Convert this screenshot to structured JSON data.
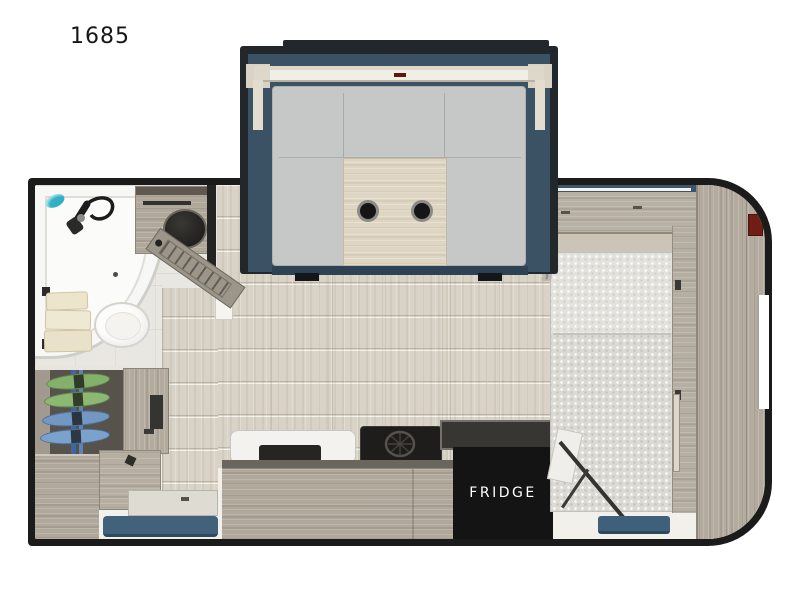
{
  "floorplan": {
    "labels": {
      "model": "1685",
      "fridge": "FRIDGE"
    },
    "colors": {
      "wall_black": "#1b1b1b",
      "slide_wall_blue": "#3a5264",
      "slide_trim_cream": "#ded8ca",
      "cushion_gray": "#c6c8c7",
      "table_wood": "#ded6c3",
      "cabinet_wood": "#b3ab9e",
      "floor_plank": "#d8d3c6",
      "bath_floor": "#e9e7e1",
      "step_mat_blue": "#42617a",
      "gear_green": "#84b06b",
      "gear_blue": "#7197c2",
      "marker_red": "#6f1d15",
      "appliance_black": "#141414",
      "shower_teal": "#2fb0c4"
    },
    "components": [
      "slide-out-dinette",
      "dinette-table-with-cupholders",
      "corner-shower",
      "toilet",
      "vanity-sink",
      "towel-rack",
      "bathroom-door",
      "gear-closet",
      "wardrobe-cabinet",
      "bench-cabinet",
      "drawer-cabinet",
      "entry-step",
      "entry-mat",
      "kitchen-counter",
      "kitchen-sink",
      "kitchen-stove",
      "fridge",
      "murphy-bed",
      "bed-side-rail",
      "front-wardrobe",
      "marker-light",
      "bed-strut",
      "bed-foot-step",
      "right-wall-window",
      "privacy-curtain"
    ]
  }
}
